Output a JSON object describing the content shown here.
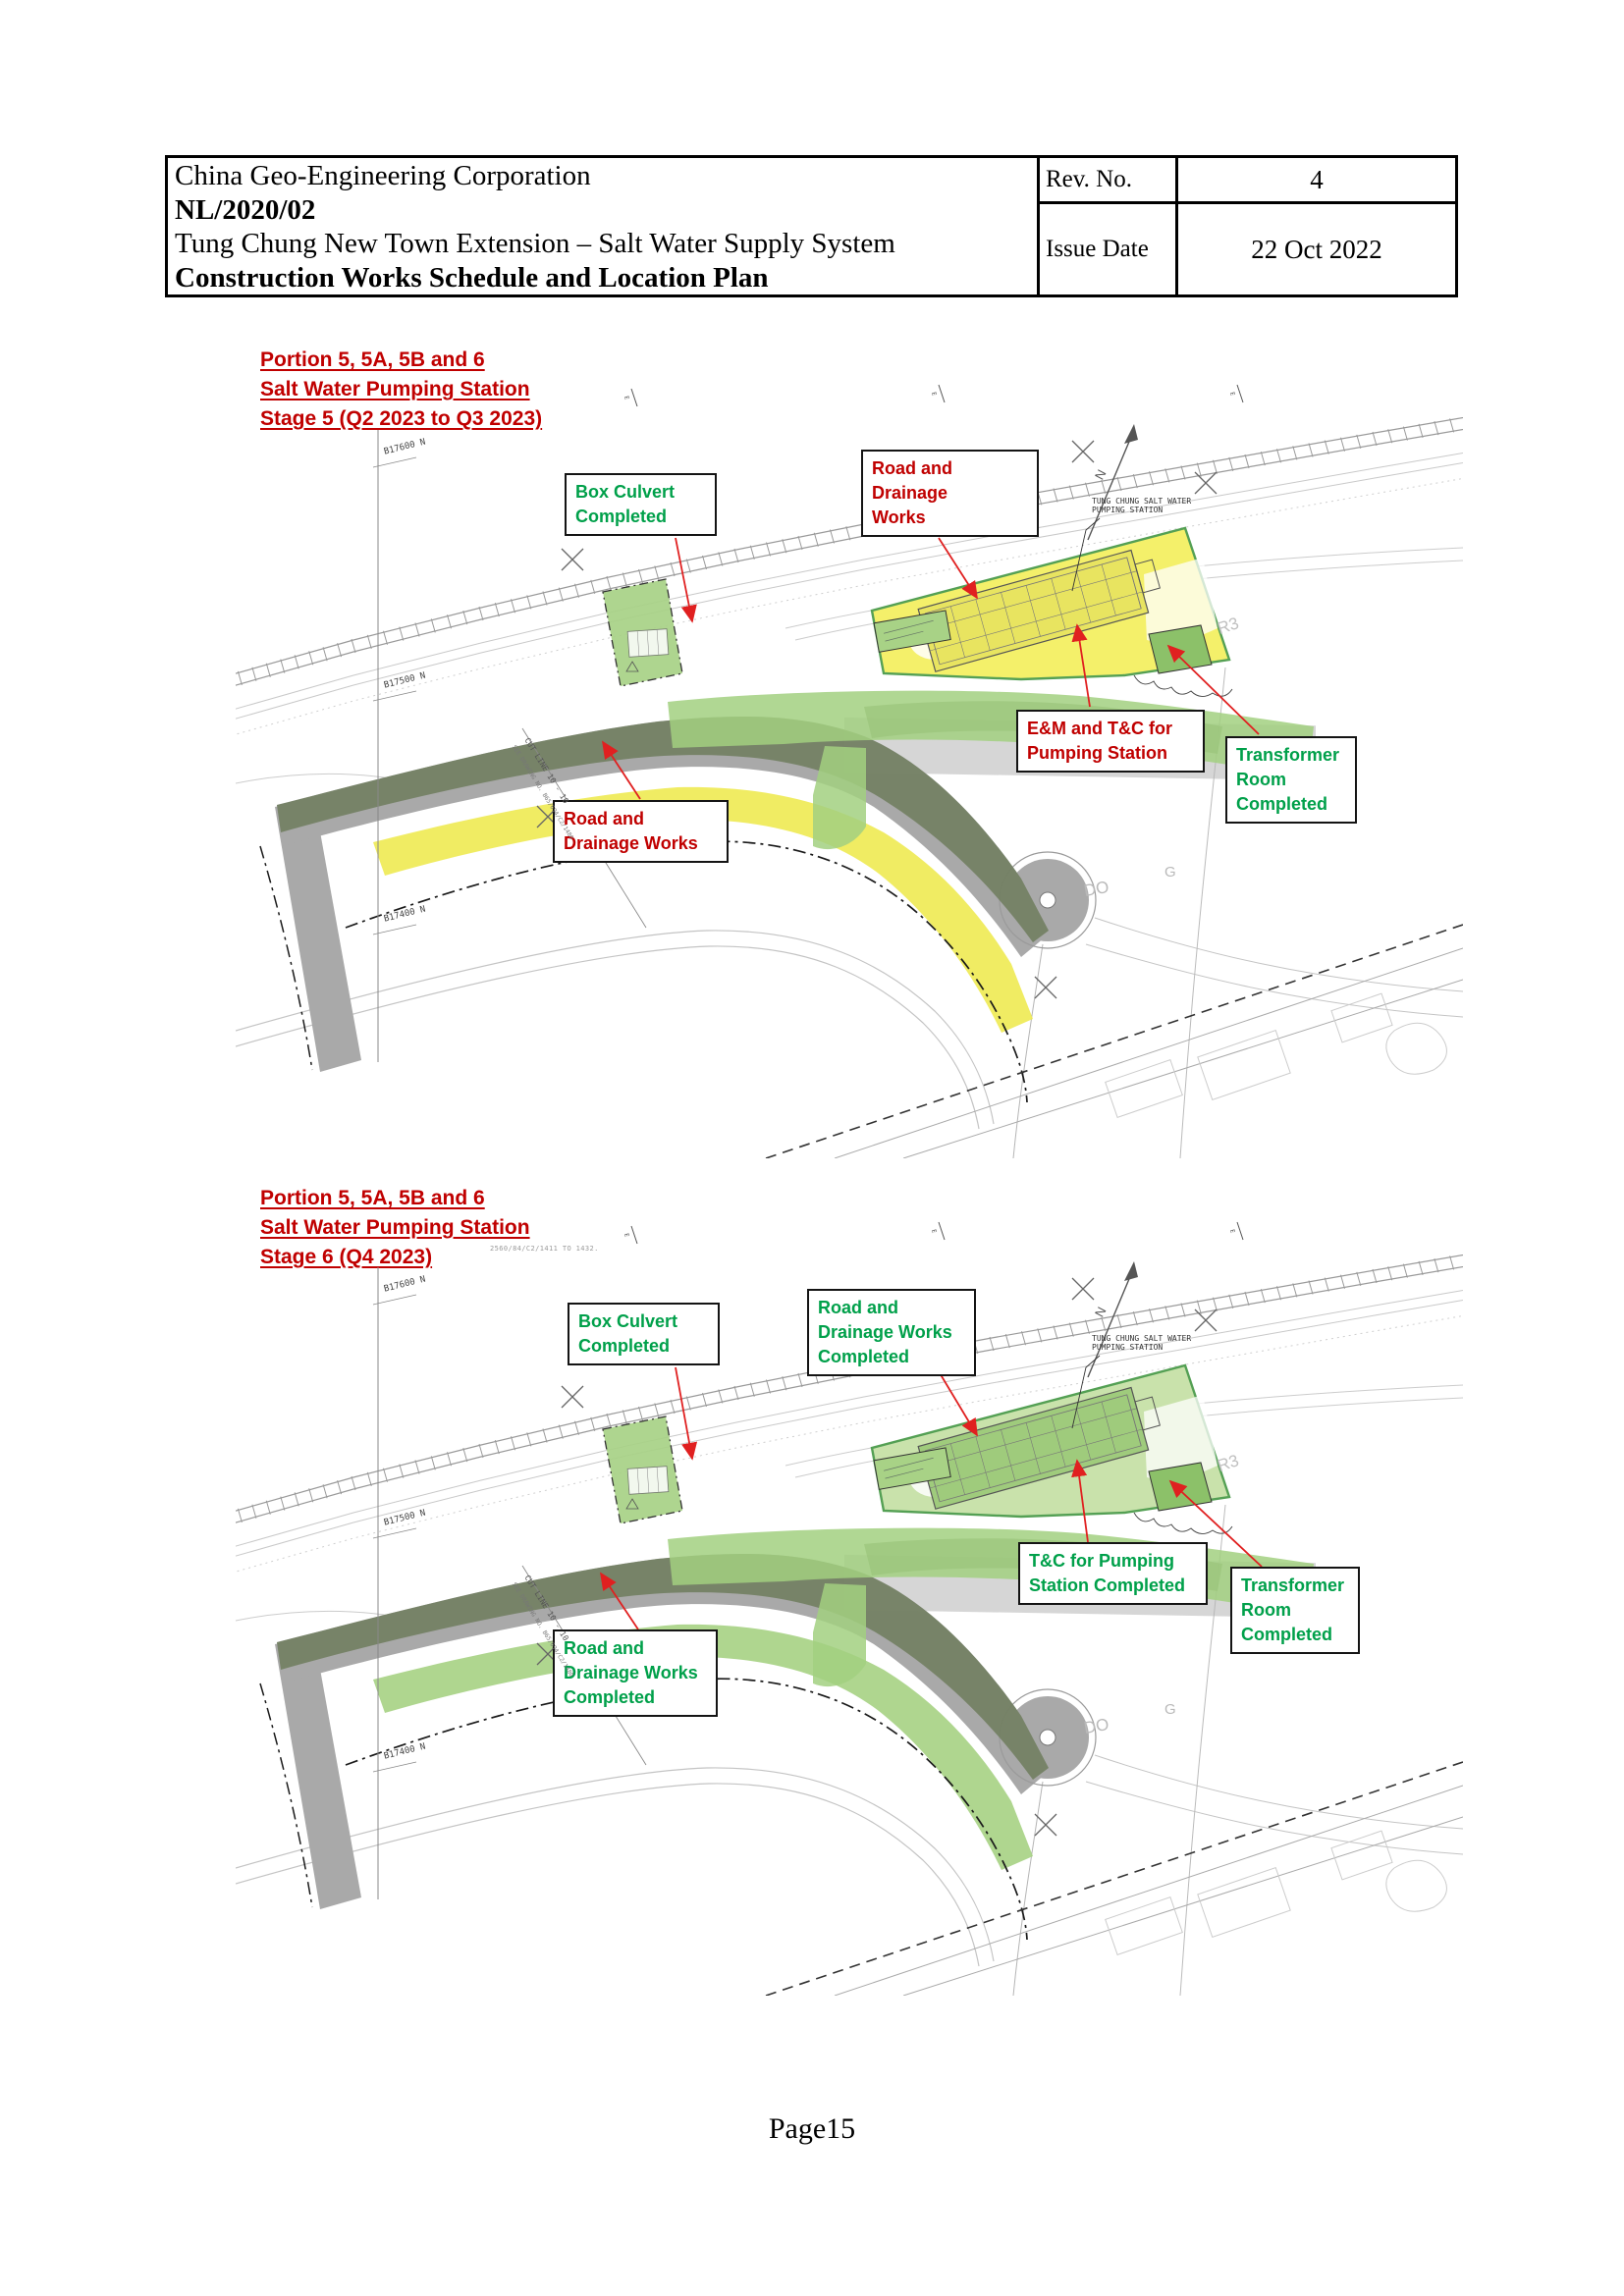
{
  "header": {
    "company": "China Geo-Engineering Corporation",
    "contract_no": "NL/2020/02",
    "project": "Tung Chung New Town Extension – Salt Water Supply System",
    "doc_title": "Construction Works Schedule and Location Plan",
    "rev_label": "Rev. No.",
    "rev_value": "4",
    "issue_date_label": "Issue Date",
    "issue_date_value": "22 Oct 2022"
  },
  "sections": [
    {
      "title_lines": [
        "Portion 5, 5A, 5B and 6",
        "Salt Water Pumping Station",
        "Stage 5 (Q2 2023 to Q3 2023)"
      ],
      "callouts": {
        "box_culvert": "Box Culvert\nCompleted",
        "road_drainage": "Road and Drainage\nWorks",
        "em_tc": "E&M and T&C for\nPumping Station",
        "transformer": "Transformer\nRoom\nCompleted",
        "road_drainage_bottom": "Road and\nDrainage Works"
      }
    },
    {
      "title_lines": [
        "Portion 5, 5A, 5B and 6",
        "Salt Water Pumping Station",
        "Stage 6 (Q4 2023)"
      ],
      "note": "2560/84/C2/1411 TO 1432.",
      "callouts": {
        "box_culvert": "Box Culvert\nCompleted",
        "road_drainage": "Road and\nDrainage Works\nCompleted",
        "tc_pumping": "T&C for Pumping\nStation Completed",
        "transformer": "Transformer\nRoom\nCompleted",
        "road_drainage_bottom": "Road and\nDrainage Works\nCompleted"
      }
    }
  ],
  "map_annotations": {
    "station_line1": "TUNG CHUNG SALT WATER",
    "station_line2": "PUMPING STATION",
    "grid_north_1": "B17600 N",
    "grid_north_2": "B17500 N",
    "grid_north_3": "B17400 N",
    "cut_line": "CUT LINE 10 - 10",
    "see_drawing": "SEE DRAWING NO. B65/694/C2/1480",
    "road_r3": "R3",
    "area_do": "DO",
    "area_g": "G",
    "north": "N"
  },
  "footer": {
    "page_number": "Page15"
  },
  "colors": {
    "heading_red": "#c00000",
    "callout_red": "#c00000",
    "callout_green": "#00a04a",
    "stage5_highlight": "#eeea52",
    "stage6_highlight": "#a6d283",
    "completed_green": "#a8d286",
    "road_grey": "#a9a9a9"
  }
}
